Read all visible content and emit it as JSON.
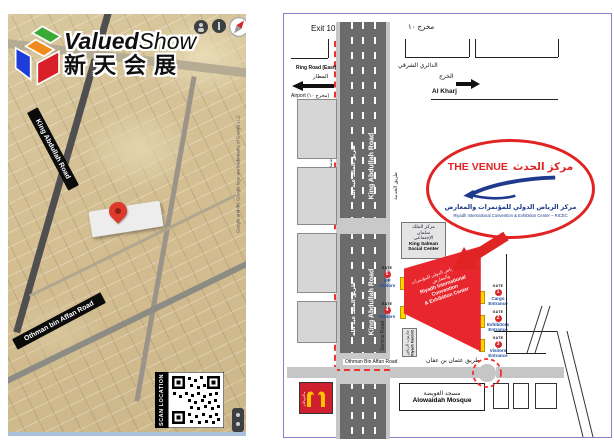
{
  "brand": {
    "name_bold": "Valued",
    "name_light": "Show",
    "name_cn": "新天会展"
  },
  "left_map": {
    "road_banner_king_abdullah": "King Abdullah Road",
    "road_banner_othman": "Othman bin Affan Road",
    "attribution": "Google and the Google logo are trademarks of Google LLC",
    "scan_label": "SCAN LOCATION"
  },
  "right_map": {
    "exit_en": "Exit 10",
    "exit_ar": "مخرج ١٠",
    "exit_rotated": "(Exit 10)",
    "ring_road_en": "Ring Road (East)",
    "ring_road_ar": "الدائري الشرقي",
    "airport_ar": "المطار",
    "airport_en": "Airport (مخرج ١٠)",
    "kharj_ar": "الخرج",
    "kharj_en": "Al Kharj",
    "king_abdullah_ar": "طريق الملك عبد الله",
    "king_abdullah_en": "King Abdullah Road",
    "service_road_ar": "طريق الخدمة",
    "service_road_en": "Service Road",
    "king_salman_ar": "مركز الملك\nسلمان\nالإجتماعي",
    "king_salman_en": "King Salman\nSocial Center",
    "venue": {
      "title_en": "THE VENUE",
      "title_ar": "مركز الحدث",
      "sub_ar": "مركز الرياض الدولي للمؤتمرات والمعارض",
      "sub_en": "Riyadh International Convention & Exhibition Center – RICEC"
    },
    "building_ar": "مركز الرياض الدولي للمؤتمرات والمعارض",
    "building_en": "Riyadh International Convention\n& Exhibition Center",
    "gate_word": "GATE",
    "gates": [
      {
        "num": "1",
        "name": "Cargo Entrance"
      },
      {
        "num": "2",
        "name": "Exhibitors Entrance"
      },
      {
        "num": "3",
        "name": "Visitors Entrance"
      },
      {
        "num": "4",
        "name": "Visitors"
      },
      {
        "num": "5",
        "name": "VIP Visitors"
      }
    ],
    "marriott_ar": "ماريوت الرياض",
    "marriott_en": "Riyadh Marriott",
    "othman_en": "Othman Bin Affan Road",
    "othman_ar": "طريق عثمان بن عفان",
    "mosque_ar": "مسجد العويضة",
    "mosque_en": "Alowaidah Mosque",
    "mcdonalds_ar": "ماكدونالدز"
  },
  "colors": {
    "route_red": "#f23030",
    "venue_red": "#e02424",
    "building_red": "#e8262d",
    "gate_blue": "#1a4fa0",
    "logo_navy": "#1d3a8f",
    "road_gray": "#6b6b6b",
    "panel_border": "#8080cc",
    "gate_yellow": "#ffd400"
  }
}
